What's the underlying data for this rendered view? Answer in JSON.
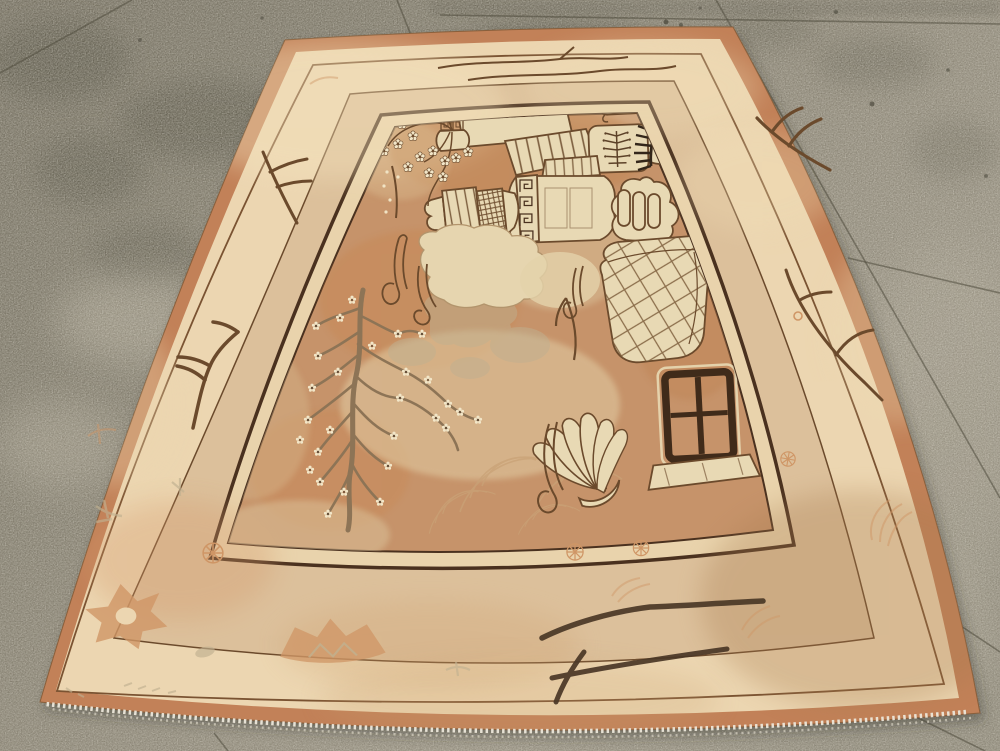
{
  "scene": {
    "type": "photograph",
    "caption": "Antique East Turkestan Khotan pictorial rug displayed at an angle on a speckled concrete floor",
    "floor": {
      "material": "speckled concrete terrazzo",
      "features": [
        "tile-joint-lines",
        "damp-dark-stains",
        "light-flecks",
        "white-efflorescence-patches"
      ]
    },
    "rug": {
      "style": "Khotan / Samarkand pictorial still-life carpet",
      "bands_outside_in": [
        "salmon selvage edge",
        "ivory outer border with branch sprigs",
        "thin brown guard stripe",
        "tan middle border with rosettes and medallions",
        "thick brown line",
        "narrow ivory inner border",
        "caramel pictorial field"
      ],
      "field_motifs": [
        "flowering-prunus-spray-in-scroll-vase",
        "spotted-leaf",
        "lattice-incense-tower",
        "jar-rim-slab",
        "striped-canopy",
        "rosette-box",
        "lidded-cup",
        "rolled-scroll",
        "berry-frond-jar",
        "dark-pine-comb",
        "greek-key-vase",
        "ruyi-paw-lobes",
        "striped-lattice-jar",
        "seal-stamp",
        "scholar-rock",
        "ribbon-scrolls",
        "blossoming-prunus-tree",
        "wave-scrolls",
        "faded-peonies",
        "buddhas-hand-citron",
        "lattice-basket",
        "altar-table-stand"
      ],
      "border_motifs": [
        "bird-foot-branch-sprigs",
        "long-wavy-branches",
        "pinwheel-rosette",
        "fan-blossom",
        "lattice-medallions",
        "sage-sprigs",
        "salmon-leaf-fans"
      ],
      "fringe": "white cotton fringe along bottom edge"
    },
    "palette": {
      "floor_dark": "#716c5d",
      "floor_mid": "#8d8777",
      "floor_light": "#9a9484",
      "floor_joint": "#4f4b3d",
      "floor_stain": "#4c483b",
      "rug_edge_salmon": "#c28158",
      "border_ivory": "#ecd6b1",
      "border_tan": "#dcc09b",
      "inner_ivory": "#e9d3ac",
      "field_caramel": "#c6936a",
      "field_worn_cream": "#e2cda4",
      "motif_cream": "#e8d9b4",
      "blossom_white": "#f2e6c8",
      "outline_brown": "#6b4a2c",
      "line_dark": "#4a311f",
      "tree_trunk": "#8d7456",
      "branch_dark": "#4a3726",
      "comb_black": "#33261a",
      "salmon_motif": "#cf9666",
      "wave_salmon": "#c9a277",
      "sage": "#c0b090",
      "fringe_white": "#ece7da",
      "table_brown": "#402b1a"
    }
  }
}
